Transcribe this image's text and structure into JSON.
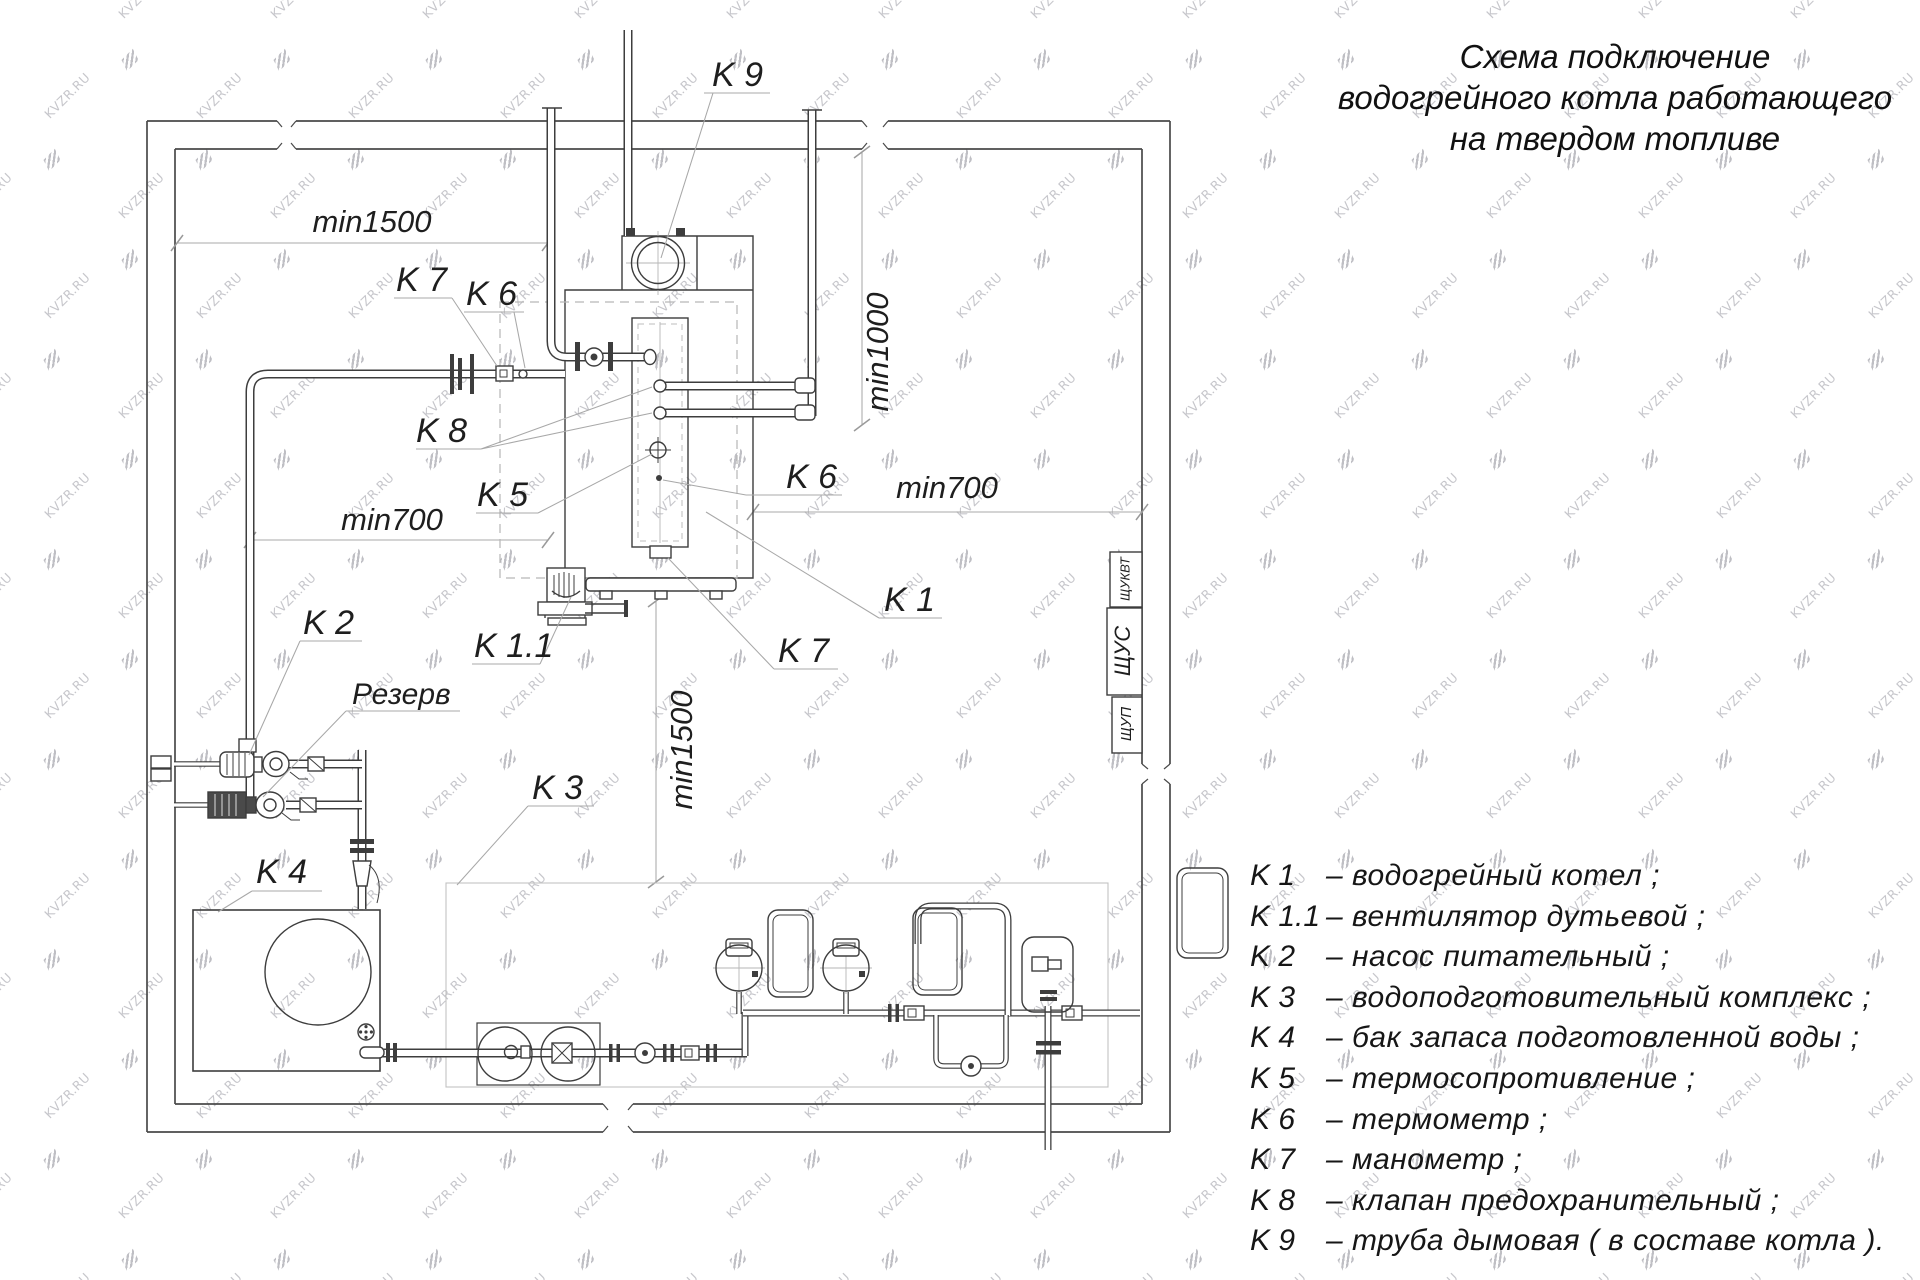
{
  "watermark": {
    "text": "KVZR.RU"
  },
  "title": {
    "line1": "Схема подключение",
    "line2": "водогрейного котла работающего",
    "line3": "на твердом топливе"
  },
  "legend": {
    "separator": "–",
    "items": [
      {
        "key": "K 1",
        "desc": "водогрейный котел ;"
      },
      {
        "key": "K 1.1",
        "desc": "вентилятор дутьевой ;"
      },
      {
        "key": "K 2",
        "desc": "насос питательный ;"
      },
      {
        "key": "K 3",
        "desc": "водоподготовительный комплекс ;"
      },
      {
        "key": "K 4",
        "desc": "бак запаса подготовленной воды ;"
      },
      {
        "key": "K 5",
        "desc": "термосопротивление ;"
      },
      {
        "key": "K 6",
        "desc": "термометр ;"
      },
      {
        "key": "K 7",
        "desc": "манометр ;"
      },
      {
        "key": "K 8",
        "desc": "клапан предохранительный ;"
      },
      {
        "key": "K 9",
        "desc": "труба дымовая ( в составе котла )."
      }
    ]
  },
  "diagram": {
    "labels": {
      "k9": "K 9",
      "k7_top": "K 7",
      "k6_top": "K 6",
      "k8": "K 8",
      "k5": "K 5",
      "k6_right": "K 6",
      "k1": "K 1",
      "k7_bottom": "K 7",
      "k11": "K 1.1",
      "k2": "K 2",
      "reserve": "Резерв",
      "k4": "K 4",
      "k3": "K 3",
      "dim_top": "min1500",
      "dim_mid_left": "min700",
      "dim_mid_right": "min700",
      "dim_vert_right": "min1000",
      "dim_vert_center": "min1500",
      "panel_top": "ЩУКВТ",
      "panel_mid": "ЩУС",
      "panel_bottom": "ЩУП"
    }
  }
}
